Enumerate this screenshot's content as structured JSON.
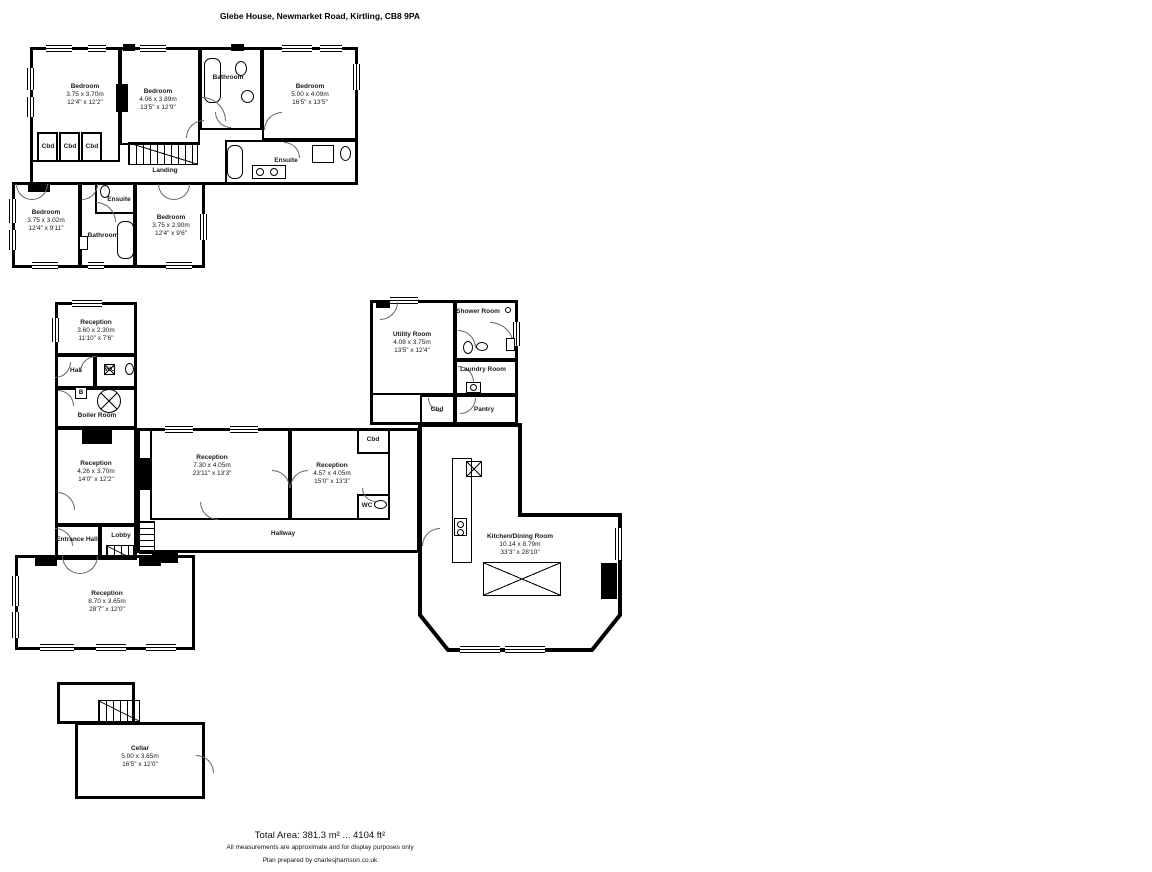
{
  "title": "Glebe House, Newmarket Road, Kirtling, CB8 9PA",
  "first_floor": {
    "bed1": {
      "name": "Bedroom",
      "m": "3.75 x 3.70m",
      "ft": "12'4\" x 12'2\""
    },
    "bed2": {
      "name": "Bedroom",
      "m": "4.06 x 3.89m",
      "ft": "13'5\" x 12'9\""
    },
    "bed3": {
      "name": "Bedroom",
      "m": "5.00 x 4.09m",
      "ft": "16'5\" x 13'5\""
    },
    "bed4": {
      "name": "Bedroom",
      "m": "3.75 x 3.02m",
      "ft": "12'4\" x 9'11\""
    },
    "bed5": {
      "name": "Bedroom",
      "m": "3.75 x 2.90m",
      "ft": "12'4\" x 9'6\""
    },
    "bathroom_top": "Bathroom",
    "bathroom_lower": "Bathroom",
    "ensuite_top": "Ensuite",
    "ensuite_lower": "Ensuite",
    "landing": "Landing",
    "cbd": "Cbd"
  },
  "ground_floor": {
    "reception_small": {
      "name": "Reception",
      "m": "3.60 x 2.30m",
      "ft": "11'10\" x 7'6\""
    },
    "hall": "Hall",
    "wc": "WC",
    "b": "B",
    "boiler_room": "Boiler Room",
    "reception_left": {
      "name": "Reception",
      "m": "4.26 x 3.70m",
      "ft": "14'0\" x 12'2\""
    },
    "reception_mid": {
      "name": "Reception",
      "m": "7.30 x 4.05m",
      "ft": "23'11\" x 13'3\""
    },
    "reception_right": {
      "name": "Reception",
      "m": "4.57 x 4.05m",
      "ft": "15'0\" x 13'3\""
    },
    "wc2": "WC",
    "cbd1": "Cbd",
    "cbd2": "Cbd",
    "hallway": "Hallway",
    "utility": {
      "name": "Utility Room",
      "m": "4.08 x 3.75m",
      "ft": "13'5\" x 12'4\""
    },
    "shower_room": "Shower Room",
    "laundry_room": "Laundry Room",
    "pantry": "Pantry",
    "kitchen": {
      "name": "Kitchen/Dining Room",
      "m": "10.14 x 8.79m",
      "ft": "33'3\" x 28'10\""
    },
    "entrance_hall": "Entrance Hall",
    "lobby": "Lobby",
    "reception_front": {
      "name": "Reception",
      "m": "8.70 x 3.65m",
      "ft": "28'7\" x 12'0\""
    }
  },
  "cellar": {
    "name": "Cellar",
    "m": "5.00 x 3.65m",
    "ft": "16'5\" x 12'0\""
  },
  "footer": {
    "total_area": "Total Area: 381.3 m² ... 4104 ft²",
    "disclaimer": "All measurements are approximate and for display purposes only",
    "prepared_by": "Plan prepared by charlesjharrison.co.uk"
  }
}
